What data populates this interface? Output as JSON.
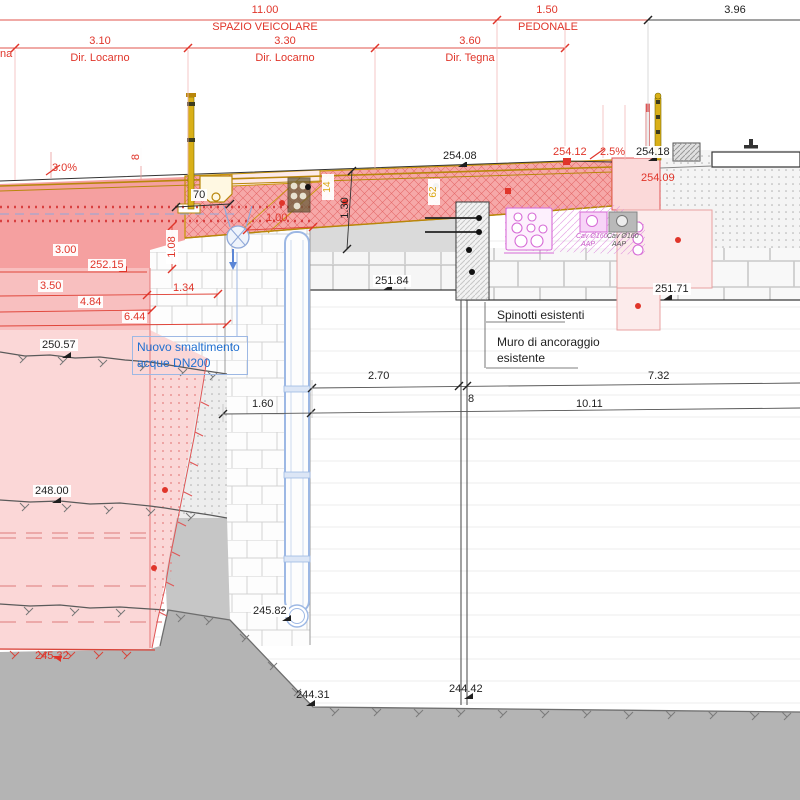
{
  "drawing": {
    "top_dims": {
      "overall_width": "11.00",
      "overall_label": "SPAZIO VEICOLARE",
      "ped_width": "1.50",
      "ped_label": "PEDONALE",
      "right_width": "3.96",
      "left_partial": "na",
      "lanes": [
        {
          "width": "3.10",
          "dir": "Dir. Locarno"
        },
        {
          "width": "3.30",
          "dir": "Dir. Locarno"
        },
        {
          "width": "3.60",
          "dir": "Dir. Tegna"
        }
      ]
    },
    "slopes": {
      "left": "3.0%",
      "right": "2.5%"
    },
    "quotas": {
      "q254_08": "254.08",
      "q254_12": "254.12",
      "q254_18": "254.18",
      "q254_09": "254.09",
      "q252_15": "252.15",
      "q251_84": "251.84",
      "q251_71": "251.71",
      "q250_57": "250.57",
      "q248_00": "248.00",
      "q245_82": "245.82",
      "q245_32": "245.32",
      "q244_31": "244.31",
      "q244_42": "244.42"
    },
    "dims": {
      "d70": "70",
      "d1_00": "1.00",
      "d1_08": "1.08",
      "d1_30": "1.30",
      "d1_34": "1.34",
      "d3_00": "3.00",
      "d3_50": "3.50",
      "d4_84": "4.84",
      "d6_44": "6.44",
      "d8_thk": "8",
      "d2_70": "2.70",
      "d7_32": "7.32",
      "d8_gap": "8",
      "d1_60": "1.60",
      "d10_11": "10.11",
      "m14": "14",
      "m62": "62"
    },
    "notes": {
      "drain_line1": "Nuovo smaltimento",
      "drain_line2": "acque DN200",
      "spinotti": "Spinotti esistenti",
      "muro_line1": "Muro di ancoraggio",
      "muro_line2": "esistente",
      "cav_magenta_l1": "Cav Ø160",
      "cav_magenta_l2": "AAP",
      "cav_gray_l1": "Cav Ø160",
      "cav_gray_l2": "AAP"
    },
    "colors": {
      "dim_red": "#e0352a",
      "dim_black": "#1f1f1f",
      "note_blue": "#1f6fd0",
      "magenta": "#d66ad6",
      "olive": "#c8960b",
      "ground_gray": "#b4b4b4"
    }
  }
}
